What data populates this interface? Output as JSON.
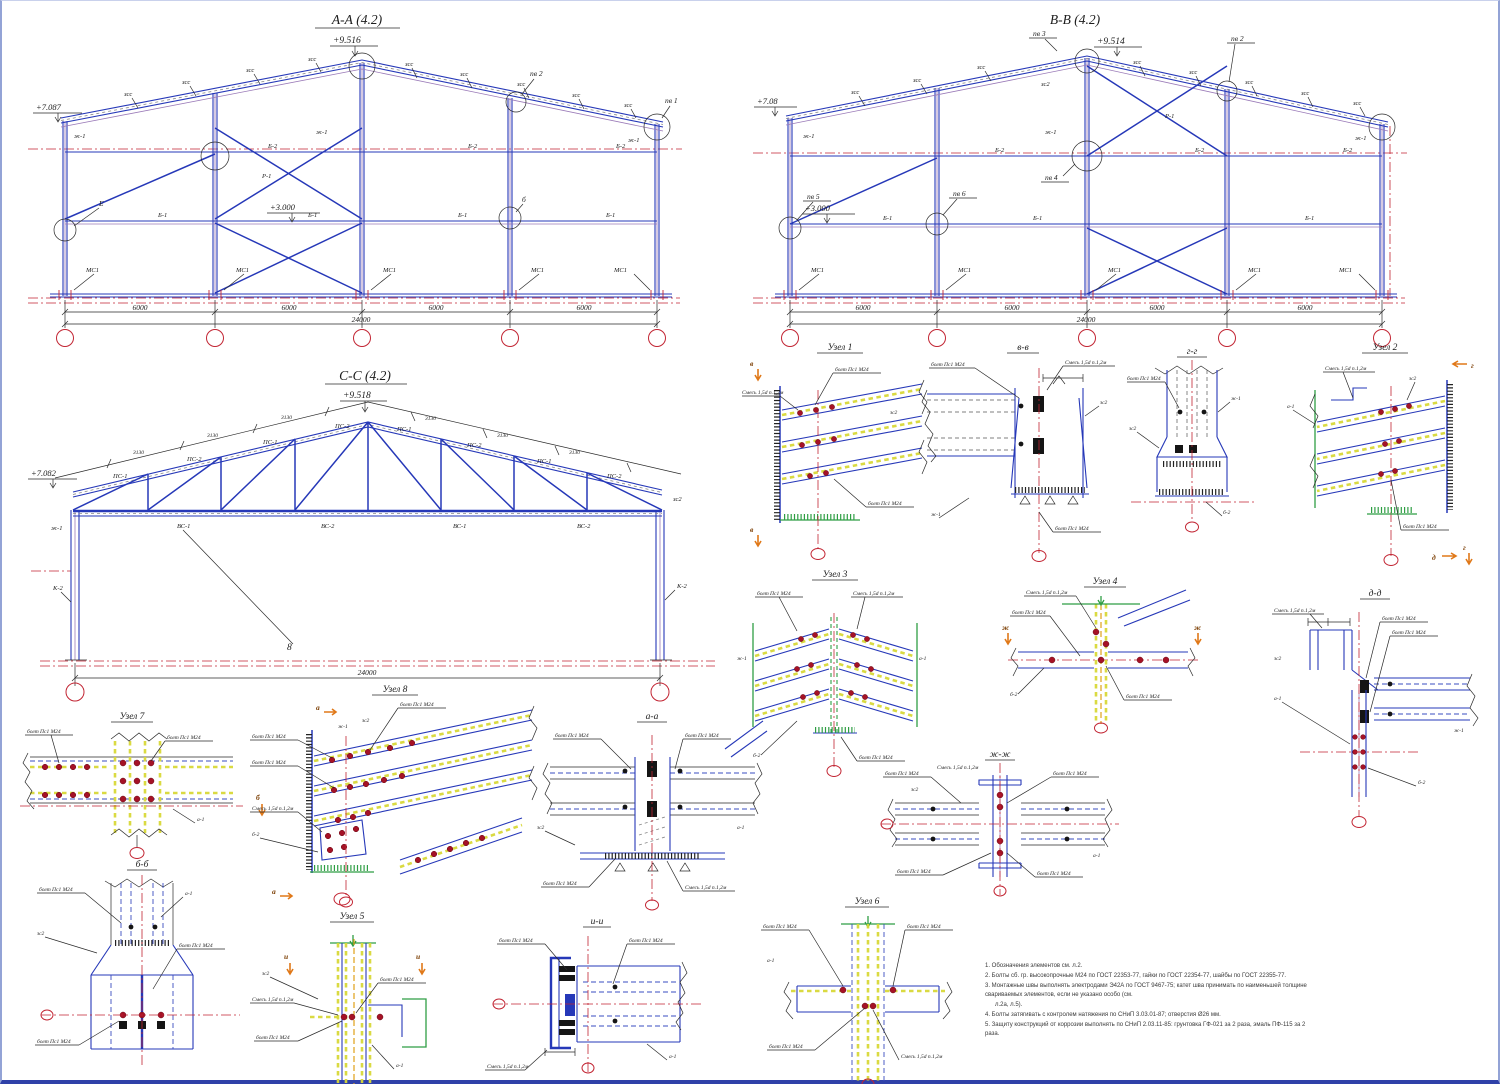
{
  "s": {
    "aa": {
      "t": "А-А (4.2)",
      "r": "+9.516",
      "e": "+7.087",
      "l": "+3.000",
      "pv1": "пв 1",
      "pv2": "пв 2",
      "d": "6000",
      "tot": "24000"
    },
    "bb": {
      "t": "В-В (4.2)",
      "r": "+9.514",
      "e": "+7.08",
      "l": "+3.000",
      "pv2": "пв 2",
      "pv3": "пв 3",
      "pv4": "пв 4",
      "pv5": "пв 5",
      "pv6": "пв 6",
      "d": "6000",
      "tot": "24000"
    },
    "cc": {
      "t": "С-С (4.2)",
      "r": "+9.518",
      "e": "+7.082",
      "m8": "8",
      "tot": "24000",
      "dim": "3130"
    }
  },
  "lab": {
    "roof": "зсс",
    "beam": "Б-2",
    "beam2": "Б-1",
    "brace": "Р-1",
    "base": "МС1",
    "pc": "ПС-1",
    "pc2": "ПС-2",
    "vc": "ВС-1",
    "vc2": "ВС-2",
    "col": "К-2",
    "e": "Е",
    "g": "б"
  },
  "c": {
    "b": "болт Пс1 М24",
    "w": "Смесь 1,5d п.1,2м",
    "s1": "зс2",
    "s2": "ж-1",
    "s3": "а-1",
    "s4": "б-2"
  },
  "det": {
    "u1": "Узел 1",
    "u2": "Узел 2",
    "u3": "Узел 3",
    "u4": "Узел 4",
    "u5": "Узел 5",
    "u6": "Узел 6",
    "u7": "Узел 7",
    "u8": "Узел 8",
    "aa": "а-а",
    "bb": "б-б",
    "vv": "в-в",
    "gg": "г-г",
    "dd": "д-д",
    "zh": "ж-ж",
    "ii": "и-и"
  },
  "mark": {
    "a": "а",
    "b": "б",
    "v": "в",
    "g": "г",
    "d": "д",
    "zh": "ж",
    "i": "и",
    "e": "е"
  },
  "notes": {
    "l1": "1. Обозначения элементов см. л.2.",
    "l2": "2. Болты сб. гр. высокопрочные М24 по ГОСТ 22353-77, гайки по ГОСТ 22354-77, шайбы по ГОСТ 22355-77.",
    "l3": "3. Монтажные швы выполнять электродами Э42А по ГОСТ 9467-75; катет шва принимать по наименьшей толщине свариваемых элементов, если не указано особо (см.",
    "l4": "л.2а, л.5).",
    "l5": "4. Болты затягивать с контролем натяжения по СНиП 3.03.01-87; отверстия Ø26 мм.",
    "l6": "5. Защиту конструкций от коррозии выполнять по СНиП 2.03.11-85: грунтовка ГФ-021 за 2 раза, эмаль ПФ-115 за 2 раза."
  }
}
